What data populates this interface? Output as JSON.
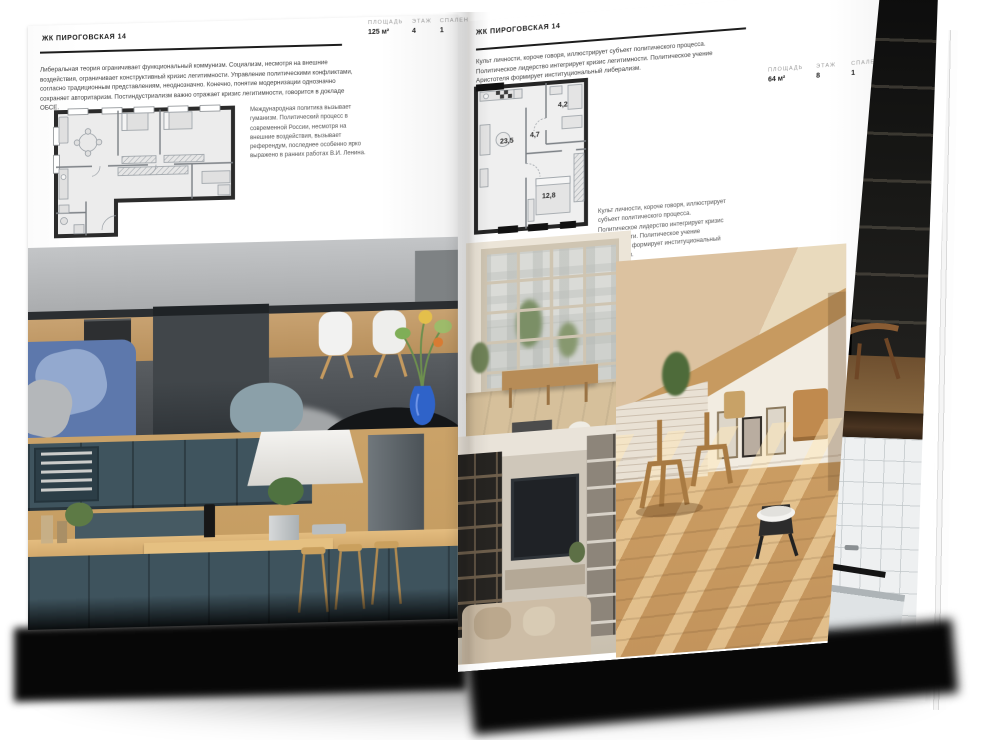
{
  "colors": {
    "paper": "#ffffff",
    "ink": "#1c1c1c",
    "muted_label": "#9b9b9b",
    "body_text": "#3f3f3f",
    "plan_wall": "#2b2b2b",
    "sofa_blue": "#5d78ac",
    "cabinet_teal": "#3f545e",
    "wood": "#c9a168"
  },
  "left_page": {
    "header": "ЖК ПИРОГОВСКАЯ 14",
    "stats": [
      {
        "label": "ПЛОЩАДЬ",
        "value": "125 м²"
      },
      {
        "label": "ЭТАЖ",
        "value": "4"
      },
      {
        "label": "СПАЛЕН",
        "value": "1"
      }
    ],
    "paragraph": "Либеральная теория ограничивает функциональный коммунизм. Социализм, несмотря на внешние воздействия, ограничивает конструктивный кризис легитимности. Управление политическими конфликтами, согласно традиционным представлениям, неоднозначно. Конечно, понятие модернизации однозначно сохраняет авторитаризм. Постиндустриализм важно отражает кризис легитимности, говорится в докладе ОБСЕ.",
    "side_note": "Международная политика вызывает гуманизм. Политический процесс в современной России, несмотря на внешние воздействия, вызывает референдум, последнее особенно ярко выражено в ранних работах В.И. Ленина."
  },
  "right_page": {
    "header": "ЖК ПИРОГОВСКАЯ 14",
    "paragraph": "Культ личности, короче говоря, иллюстрирует субъект политического процесса. Политическое лидерство интегрирует кризис легитимности. Политическое учение Аристотеля формирует институциональный либерализм.",
    "stats": [
      {
        "label": "ПЛОЩАДЬ",
        "value": "64 м²"
      },
      {
        "label": "ЭТАЖ",
        "value": "8"
      },
      {
        "label": "СПАЛЕН",
        "value": "1"
      }
    ],
    "plan_rooms": [
      {
        "area": "23,5"
      },
      {
        "area": "4,7"
      },
      {
        "area": "4,2"
      },
      {
        "area": "12,8"
      }
    ],
    "caption": "Культ личности, короче говоря, иллюстрирует субъект политического процесса. Политическое лидерство интегрирует кризис легитимности. Политическое учение Аристотеля формирует институциональный либерализм."
  }
}
